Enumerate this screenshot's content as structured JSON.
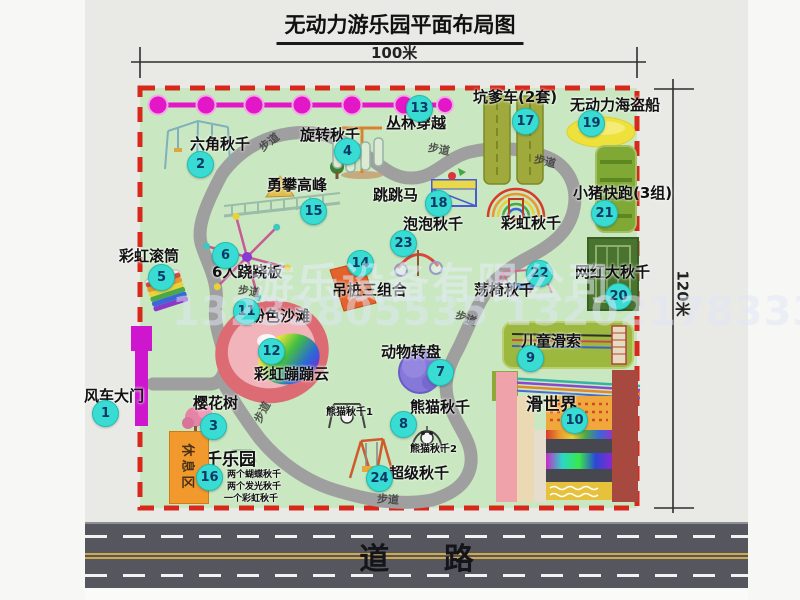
{
  "title": "无动力游乐园平面布局图",
  "dimensions": {
    "width_label": "100米",
    "height_label": "120米"
  },
  "road": {
    "label": "道 路"
  },
  "watermark": {
    "line1": "游乐设备有限公司",
    "line2": "13233805535 13202178333"
  },
  "trail_label": "步道",
  "rest_area_label": "休息区",
  "attractions": [
    {
      "num": "1",
      "name": "风车大门"
    },
    {
      "num": "2",
      "name": "六角秋千"
    },
    {
      "num": "3",
      "name": "樱花树"
    },
    {
      "num": "4",
      "name": "旋转秋千"
    },
    {
      "num": "5",
      "name": "彩虹滚筒"
    },
    {
      "num": "6",
      "name": "6人跷跷板"
    },
    {
      "num": "7",
      "name": "动物转盘"
    },
    {
      "num": "8",
      "name": "熊猫秋千"
    },
    {
      "num": "9",
      "name": "儿童滑索"
    },
    {
      "num": "10",
      "name": "滑世界"
    },
    {
      "num": "11",
      "name": "粉色沙滩"
    },
    {
      "num": "12",
      "name": "彩虹蹦蹦云"
    },
    {
      "num": "13",
      "name": "丛林穿越"
    },
    {
      "num": "14",
      "name": "吊桩三组合"
    },
    {
      "num": "15",
      "name": "勇攀高峰"
    },
    {
      "num": "16",
      "name": "秋千乐园"
    },
    {
      "num": "17",
      "name": "坑爹车(2套)"
    },
    {
      "num": "18",
      "name": "跳跳马"
    },
    {
      "num": "19",
      "name": "无动力海盗船"
    },
    {
      "num": "20",
      "name": "网红大秋千"
    },
    {
      "num": "21",
      "name": "小猪快跑(3组)"
    },
    {
      "num": "22",
      "name": "荡椅秋千"
    },
    {
      "num": "23",
      "name": "泡泡秋千"
    },
    {
      "num": "24",
      "name": "超级秋千"
    }
  ],
  "extra_labels": {
    "rainbow_swing": "彩虹秋千",
    "panda_swing_1": "熊猫秋千1",
    "panda_swing_2": "熊猫秋千2"
  },
  "swing_park_details": [
    "两个蝴蝶秋千",
    "两个发光秋千",
    "一个彩虹秋千"
  ],
  "colors": {
    "badge": "#38dcd2",
    "map_border": "#d8281c",
    "map_bg": "#c9e7c0",
    "zipline": "#e316c8",
    "road": "#56565e",
    "rest_area": "#f2992e"
  }
}
